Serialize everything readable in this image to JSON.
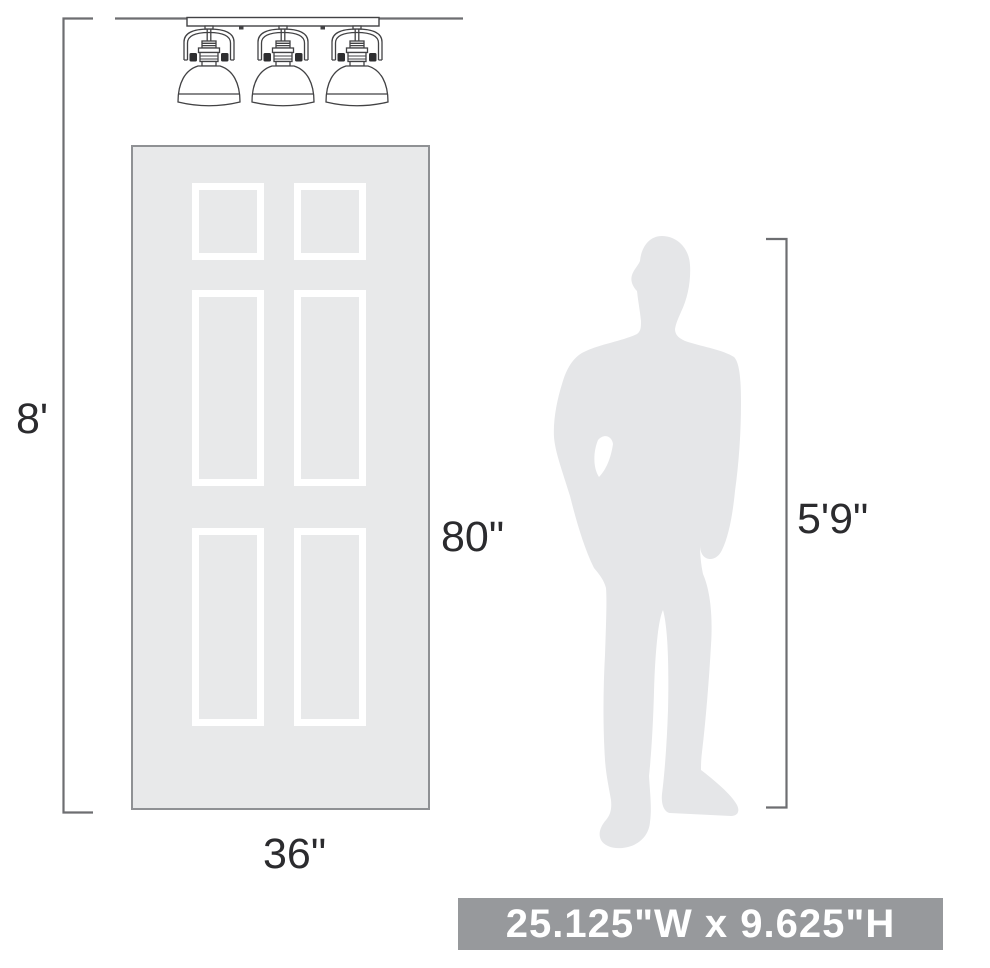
{
  "page": {
    "width_px": 990,
    "height_px": 968,
    "background": "#ffffff"
  },
  "fixture": {
    "name": "three-light vanity fixture",
    "light_count": 3,
    "stroke": "#424244"
  },
  "door": {
    "panel_count": 6,
    "fill": "#e8e9ea",
    "outline": "#8f9194",
    "panel_frame": "#ffffff"
  },
  "person": {
    "fill": "#e5e6e8"
  },
  "linework": {
    "color": "#6d6e71"
  },
  "labels": {
    "wall_height": "8'",
    "door_height": "80\"",
    "door_width": "36\"",
    "person_height": "5'9\"",
    "text_color": "#2b2b2e"
  },
  "banner": {
    "text": "25.125\"W x 9.625\"H",
    "background": "#97999c",
    "text_color": "#ffffff"
  }
}
